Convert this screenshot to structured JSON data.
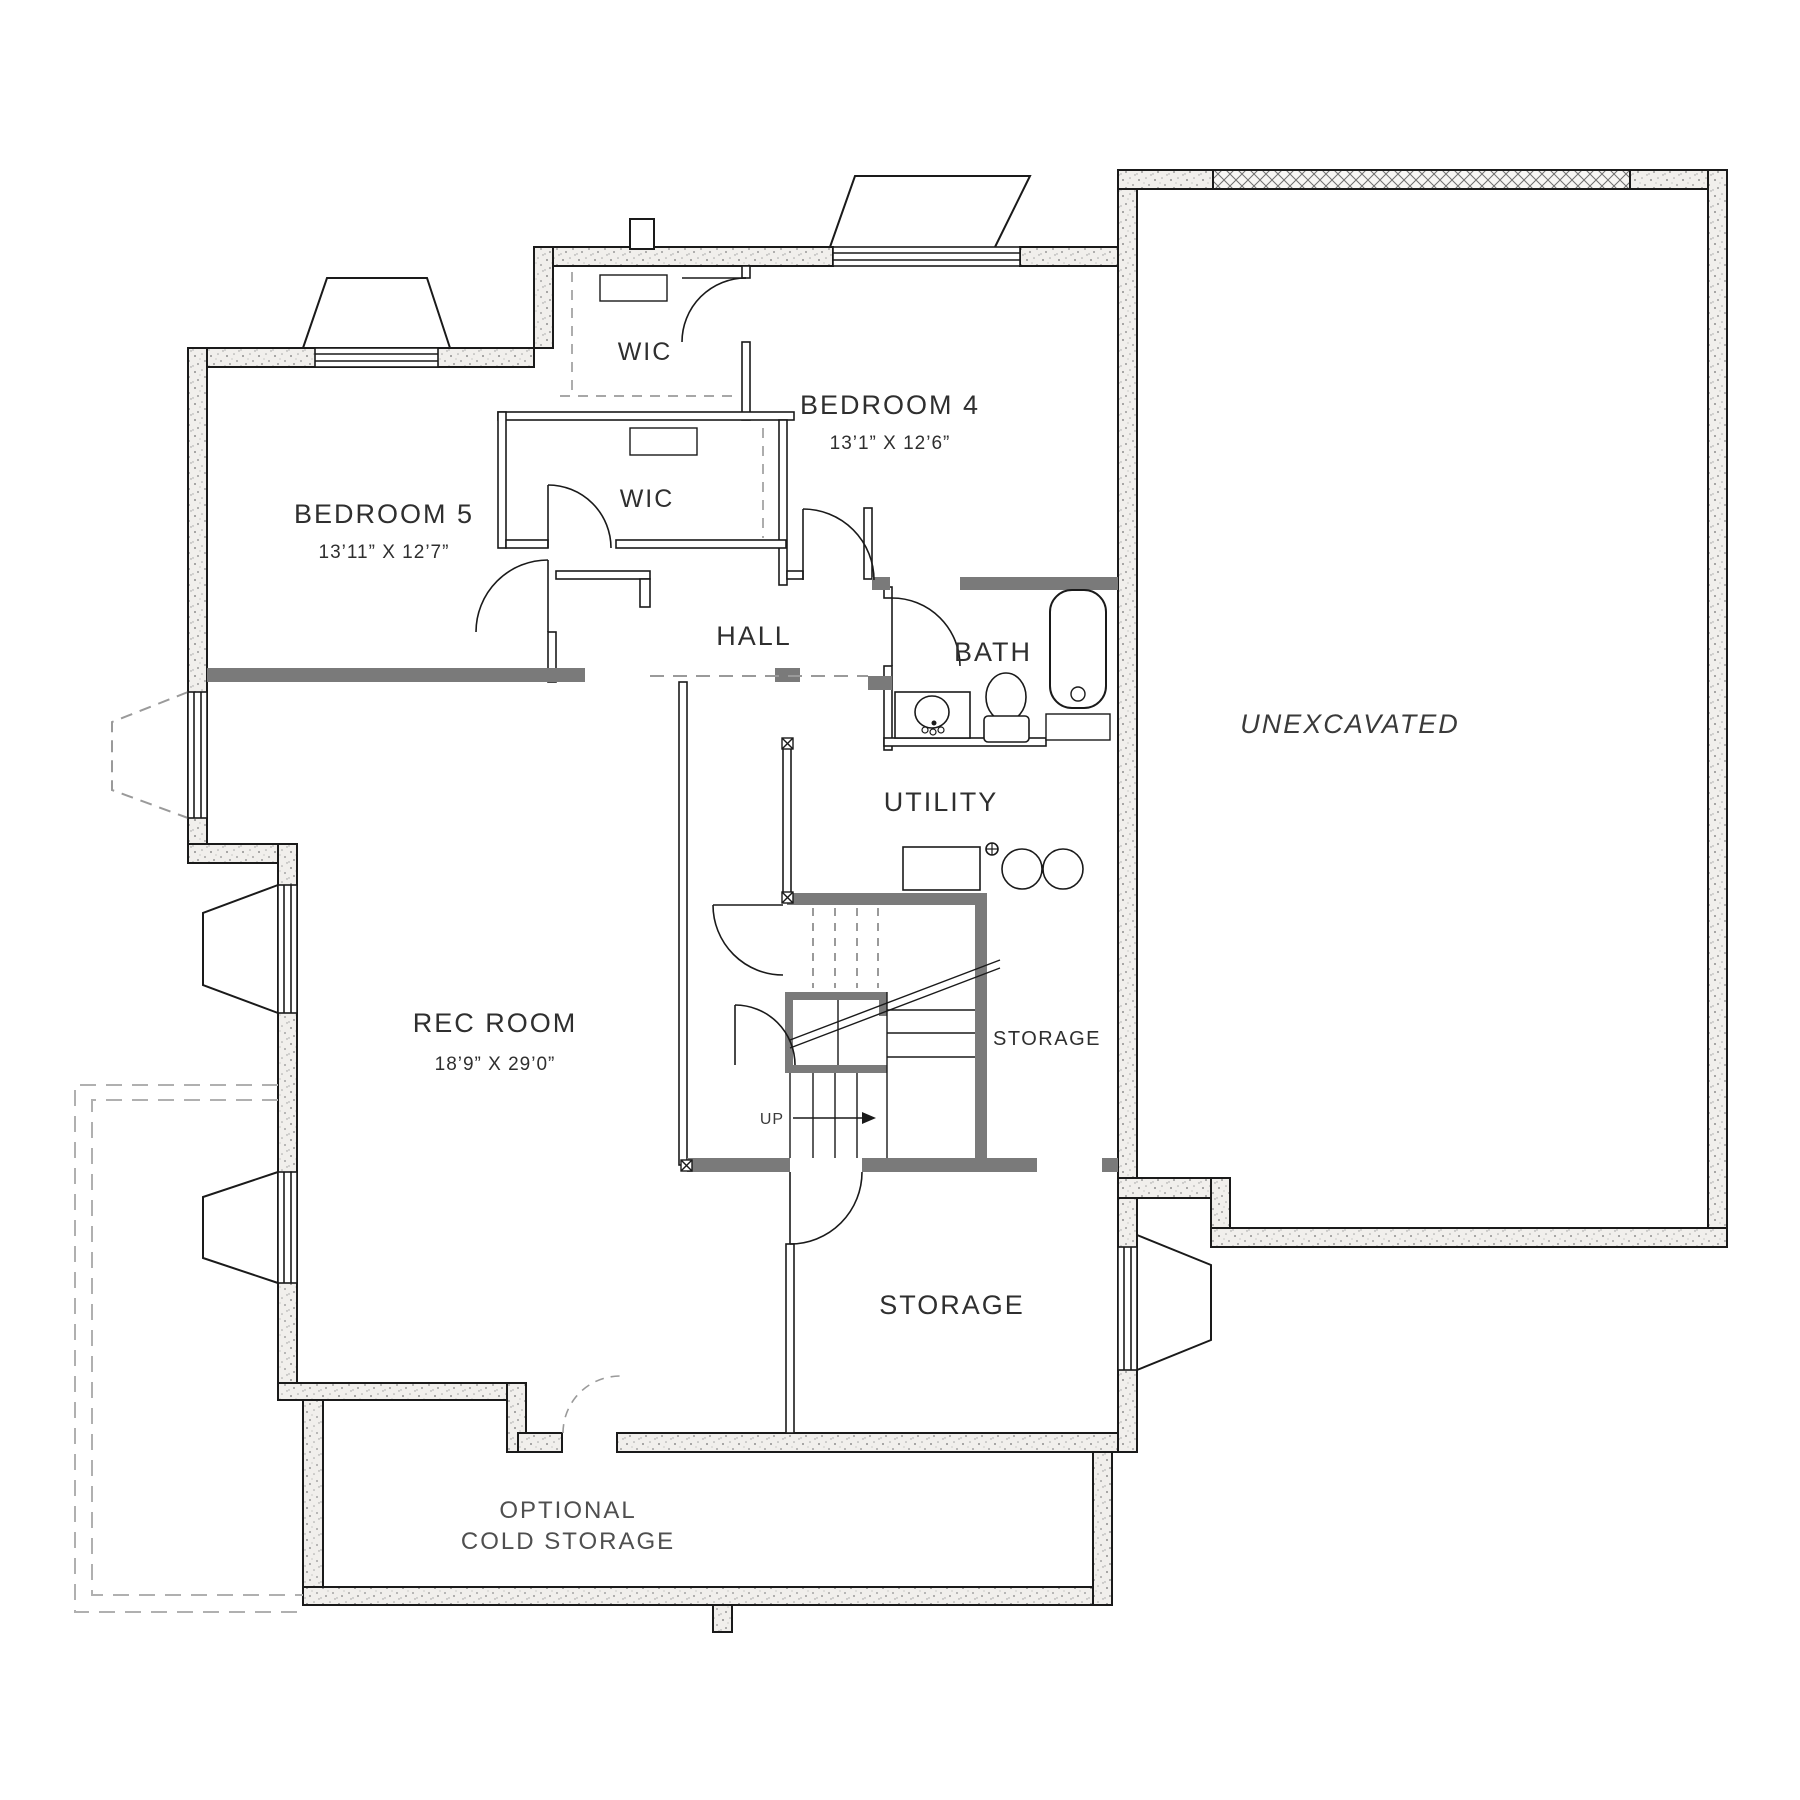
{
  "rooms": {
    "bedroom5": {
      "label": "BEDROOM 5",
      "dims": "13’11” X 12’7”"
    },
    "bedroom4": {
      "label": "BEDROOM 4",
      "dims": "13’1” X 12’6”"
    },
    "wic_upper": {
      "label": "WIC"
    },
    "wic_lower": {
      "label": "WIC"
    },
    "hall": {
      "label": "HALL"
    },
    "bath": {
      "label": "BATH"
    },
    "utility": {
      "label": "UTILITY"
    },
    "rec_room": {
      "label": "REC ROOM",
      "dims": "18’9” X 29’0”"
    },
    "storage_upper": {
      "label": "STORAGE"
    },
    "storage_lower": {
      "label": "STORAGE"
    },
    "unexcavated": {
      "label": "UNEXCAVATED"
    },
    "cold_storage": {
      "line1": "OPTIONAL",
      "line2": "COLD STORAGE"
    }
  },
  "stairs": {
    "up_label": "UP"
  },
  "colors": {
    "wall_outline": "#1a1a1a",
    "wall_fill_speckle": "#f1efec",
    "dark_wall": "#7a7a7a",
    "dashed_gray": "#b0b0b0",
    "text": "#2f2f2f"
  }
}
